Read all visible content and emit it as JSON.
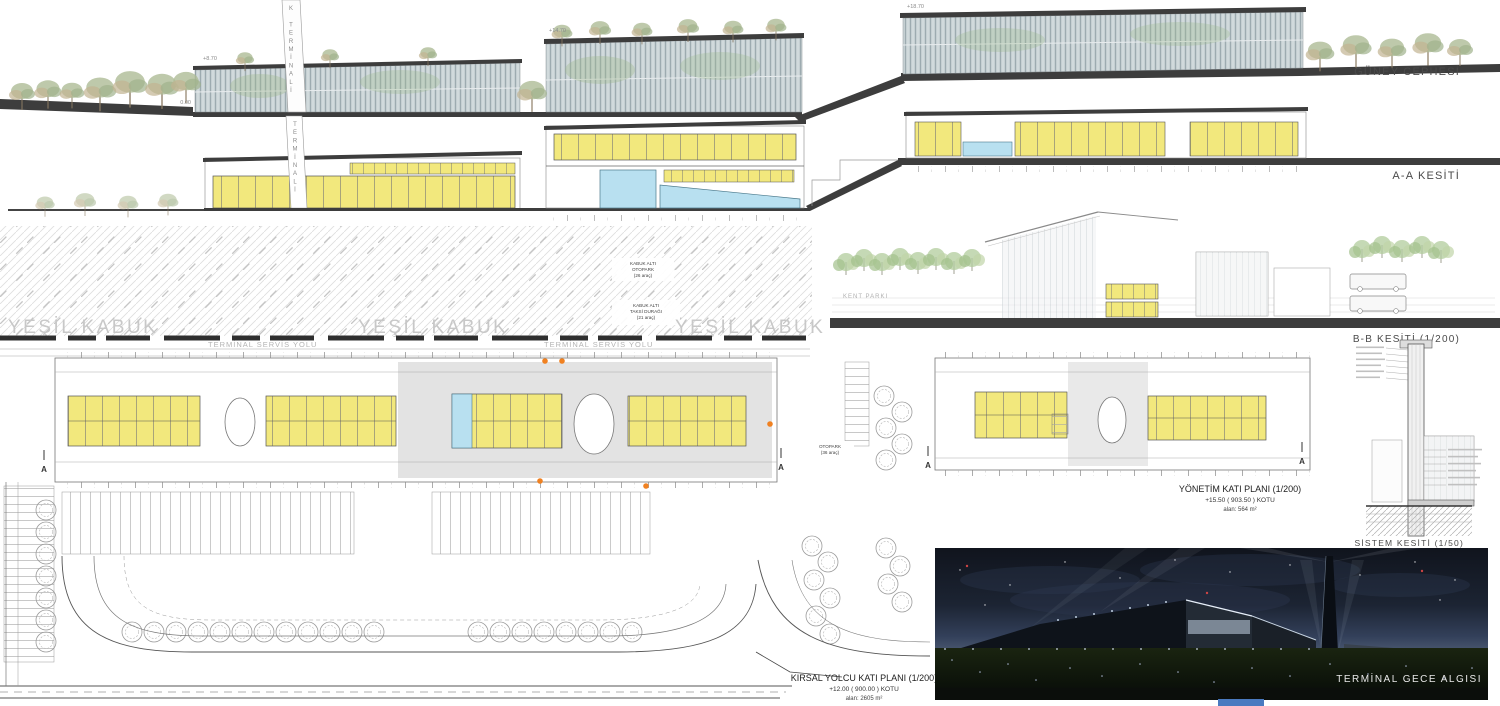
{
  "titles": {
    "south_elevation": "GÜNEY CEPHESİ",
    "section_aa": "A-A KESİTİ",
    "section_bb": "B-B KESİTİ (1/200)",
    "system_section": "SİSTEM KESİTİ (1/50)",
    "night_view": "TERMİNAL GECE ALGISI"
  },
  "south_elevation": {
    "level_870": "+8.70",
    "level_000": "0.00",
    "level_1470": "+14.70",
    "level_1870": "+18.70",
    "tower_text": "K TERMİNALİ"
  },
  "section_aa": {
    "tower_text": "TERMİNALİ"
  },
  "roof_plan": {
    "green_shell": "YEŞİL KABUK",
    "otopark_note": [
      "KABUK ALTI",
      "OTOPARK",
      "(26 araç)"
    ],
    "taksi_note": [
      "KABUK ALTI",
      "TAKSİ DURAĞI",
      "(21 araç)"
    ],
    "service_road": "TERMİNAL SERVİS YOLU"
  },
  "section_bb": {
    "kent_parki": "KENT PARKI"
  },
  "plans": {
    "kirsal": {
      "title": "KIRSAL YOLCU KATI PLANI (1/200)",
      "kotu": "+12.00 ( 900.00 ) KOTU",
      "alan": "alan: 2605 m²",
      "otopark_note": [
        "OTOPARK",
        "(36 araç)"
      ],
      "section_marker": "A"
    },
    "yonetim": {
      "title": "YÖNETİM KATI PLANI (1/200)",
      "kotu": "+15.50 ( 903.50 ) KOTU",
      "alan": "alan: 564 m²",
      "section_marker": "A"
    }
  },
  "colors": {
    "room_yellow": "#f2e87d",
    "water_blue": "#b8e0f0",
    "band_dark": "#3d3d3d",
    "marker_orange": "#f08121",
    "footer_blue": "#4a7ac0"
  }
}
